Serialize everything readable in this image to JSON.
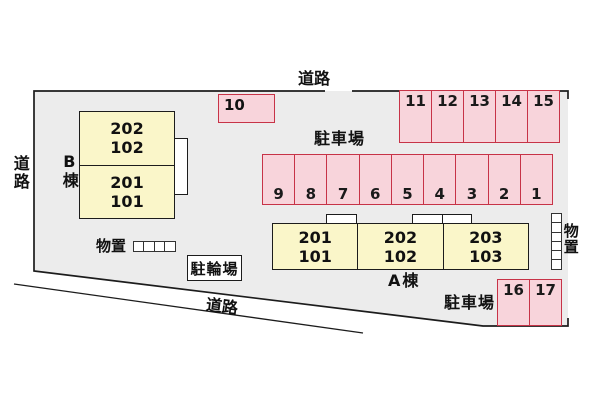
{
  "roads": {
    "top": "道路",
    "left": "道路",
    "bottom": "道路"
  },
  "parking": {
    "lot_label_main": "駐車場",
    "lot_label_south": "駐車場",
    "row_spaces": [
      "9",
      "8",
      "7",
      "6",
      "5",
      "4",
      "3",
      "2",
      "1"
    ],
    "north_spaces": [
      "11",
      "12",
      "13",
      "14",
      "15"
    ],
    "single_space": "10",
    "south_spaces": [
      "16",
      "17"
    ]
  },
  "buildings": {
    "a": {
      "label": "A棟",
      "units": [
        {
          "upper": "201",
          "lower": "101"
        },
        {
          "upper": "202",
          "lower": "102"
        },
        {
          "upper": "203",
          "lower": "103"
        }
      ]
    },
    "b": {
      "label": "B棟",
      "units": [
        {
          "upper": "202",
          "lower": "102"
        },
        {
          "upper": "201",
          "lower": "101"
        }
      ]
    }
  },
  "storage": {
    "west_label": "物置",
    "east_label": "物置"
  },
  "bicycle": {
    "label": "駐輪場"
  },
  "colors": {
    "site_fill": "#ececec",
    "stall_fill": "#f8d4db",
    "stall_border": "#c73347",
    "building_fill": "#faf6c9",
    "line": "#1c1c1c"
  }
}
